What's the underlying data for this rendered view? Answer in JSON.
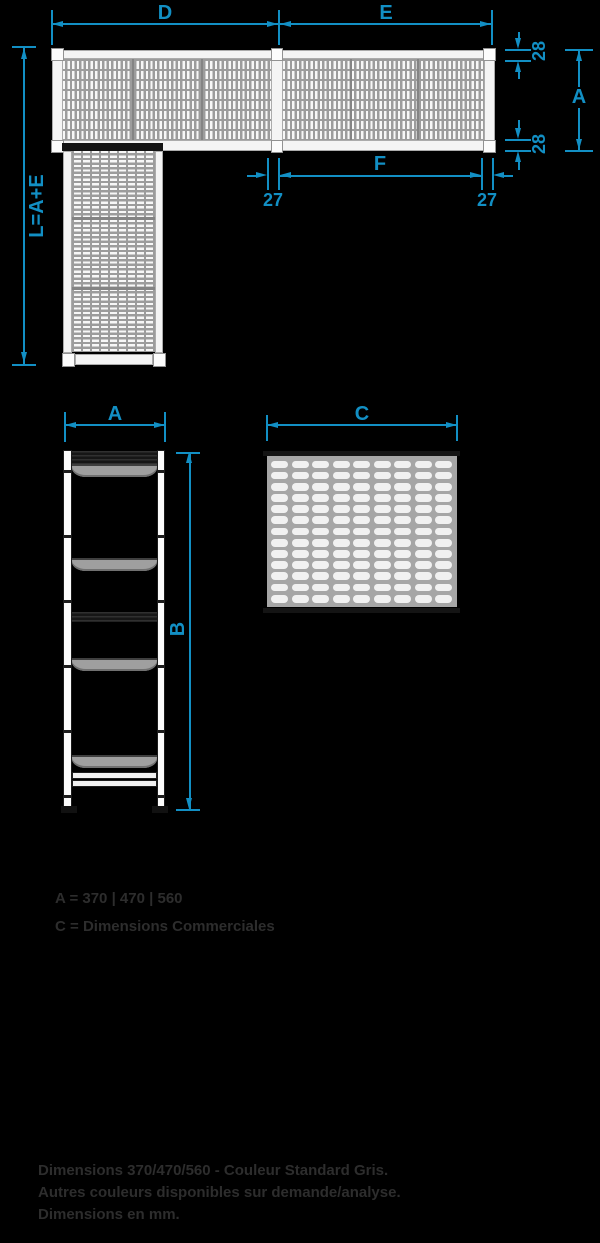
{
  "colors": {
    "accent": "#128fc4",
    "annotation_text": "#2d2d2d",
    "background": "#000000"
  },
  "plan_view": {
    "dim_d": "D",
    "dim_e": "E",
    "dim_left_vertical": "L=A+E",
    "dim_overall_width": "A",
    "dim_rail_top": "28",
    "dim_rail_bottom": "28",
    "dim_f": "F",
    "dim_offset_left": "27",
    "dim_offset_right": "27"
  },
  "side_view": {
    "dim_width": "A",
    "dim_height": "B"
  },
  "panel": {
    "dim_width": "C",
    "rows": 13,
    "cols": 9
  },
  "legend": {
    "line1_label": "A",
    "line1_value": " = 370 | 470 | 560",
    "line2_label": "C",
    "line2_value": " = Dimensions Commerciales"
  },
  "footer": {
    "line1": "Dimensions 370/470/560 - Couleur Standard Gris.",
    "line2": "Autres couleurs disponibles sur demande/analyse.",
    "line3": "Dimensions en mm."
  }
}
